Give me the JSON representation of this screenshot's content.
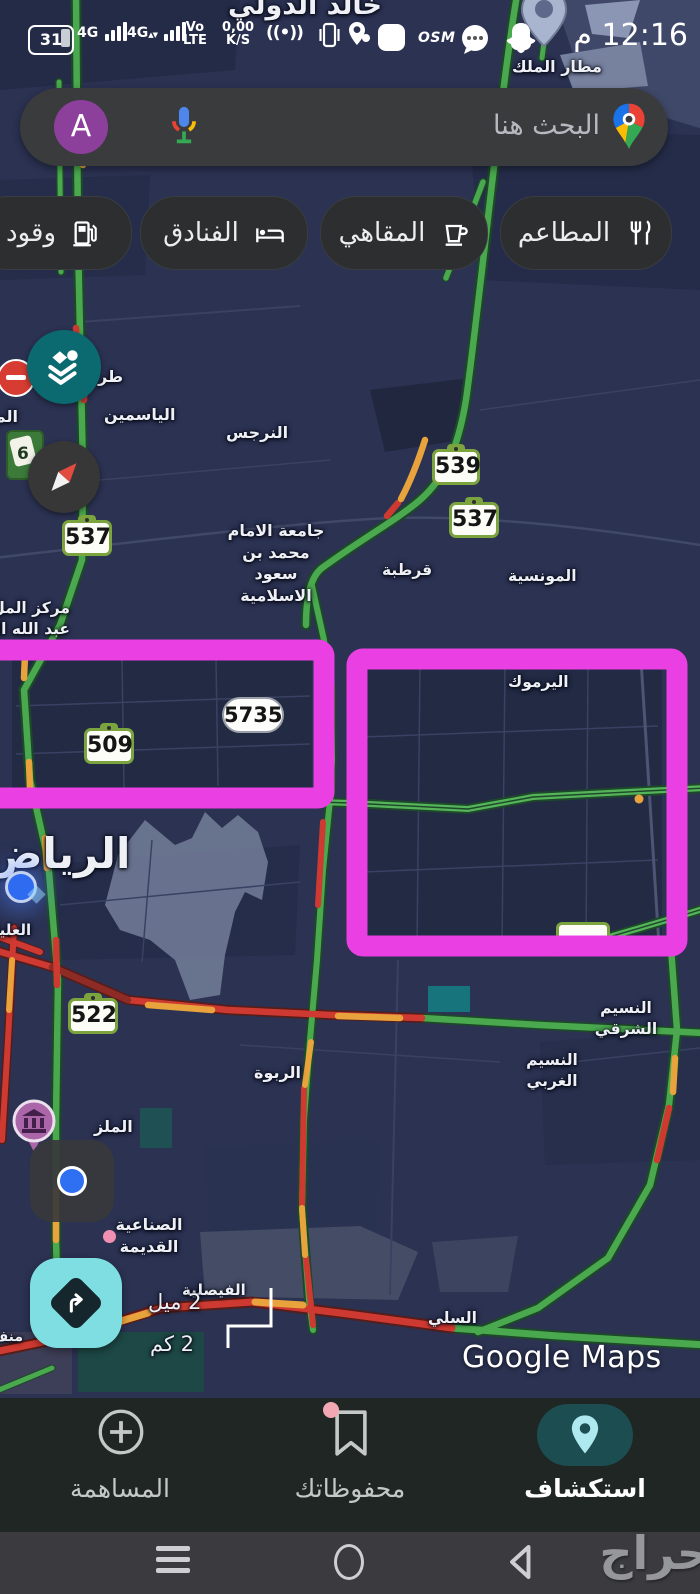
{
  "colors": {
    "annotation_magenta": "#ea3fe3",
    "road_green": "#4aa84f",
    "road_orange": "#e8a33d",
    "road_red": "#ce3a31",
    "layers_fab_teal": "#0b6a70",
    "directions_fab": "#7edee2",
    "nav_active_pill": "#1c4d50"
  },
  "status_bar": {
    "battery": "31",
    "net_a": "4G",
    "net_b": "4G",
    "volte_line1": "Vo",
    "volte_line2": "LTE",
    "speed_line1": "0,00",
    "speed_line2": "K/S",
    "osm_badge": "OSM",
    "time": "12:16 م"
  },
  "search": {
    "placeholder": "البحث هنا",
    "avatar_letter": "A"
  },
  "chips": [
    {
      "label": "المطاعم",
      "icon": "restaurant-icon"
    },
    {
      "label": "المقاهي",
      "icon": "cafe-icon"
    },
    {
      "label": "الفنادق",
      "icon": "hotel-icon"
    },
    {
      "label": "وقود",
      "icon": "fuel-icon"
    }
  ],
  "map": {
    "city_label": "الرياض",
    "labels": [
      {
        "text": "خالد الدولي"
      },
      {
        "text": "مطار الملك"
      },
      {
        "text": "طر"
      },
      {
        "text": "الم"
      },
      {
        "text": "الياسمين"
      },
      {
        "text": "النرجس"
      },
      {
        "text": "جامعة الامام\nمحمد بن سعود\nالاسلامية"
      },
      {
        "text": "قرطبة"
      },
      {
        "text": "المونسية"
      },
      {
        "text": "مركز المل\nعبد الله ال"
      },
      {
        "text": "اليرموك"
      },
      {
        "text": "العليا"
      },
      {
        "text": "الربوة"
      },
      {
        "text": "النسيم\nالشرقي"
      },
      {
        "text": "النسيم\nالغربي"
      },
      {
        "text": "الملز"
      },
      {
        "text": "الصناعية\nالقديمة"
      },
      {
        "text": "الفيصلية"
      },
      {
        "text": "السلي"
      },
      {
        "text": "منف"
      }
    ],
    "shields": [
      {
        "num": "539"
      },
      {
        "num": "537"
      },
      {
        "num": "537"
      },
      {
        "num": "5735"
      },
      {
        "num": "509"
      },
      {
        "num": "522"
      },
      {
        "num": "6"
      }
    ],
    "scale": {
      "miles": "2 ميل",
      "km": "2 كم"
    },
    "watermark": "Google Maps"
  },
  "bottom_nav": {
    "items": [
      {
        "label": "المساهمة",
        "active": false
      },
      {
        "label": "محفوظاتك",
        "active": false
      },
      {
        "label": "استكشاف",
        "active": true
      }
    ]
  },
  "overlay_watermark": "حراج"
}
